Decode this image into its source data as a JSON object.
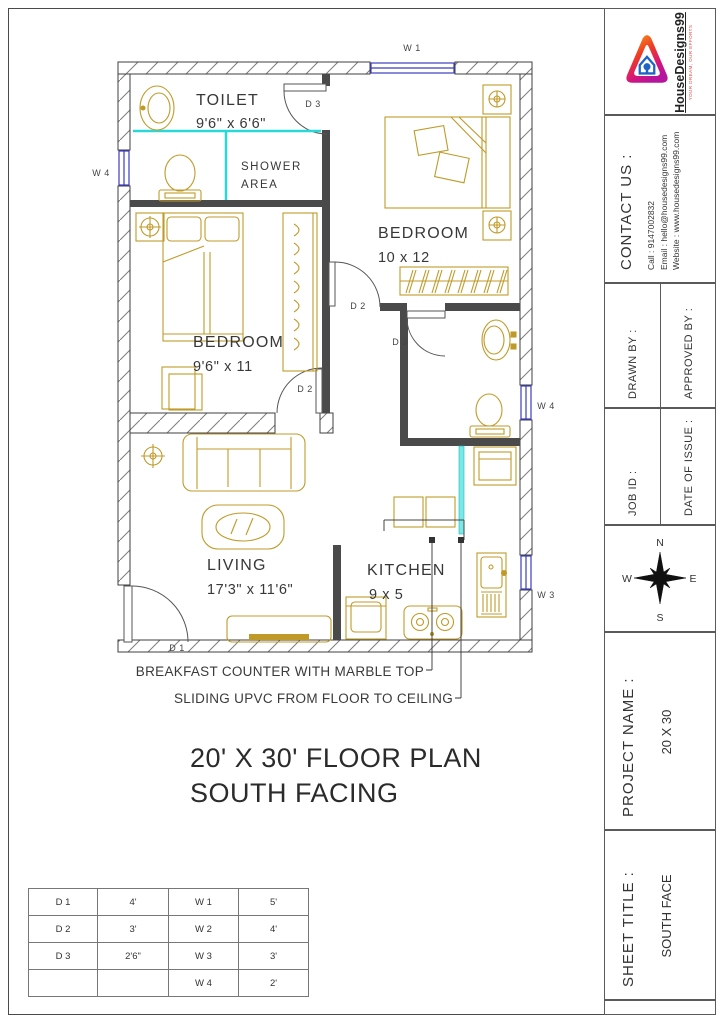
{
  "title_block": {
    "logo": {
      "name": "HouseDesigns99",
      "tagline": "YOUR DREAM, OUR EFFORTS"
    },
    "contact": {
      "heading": "CONTACT US :",
      "call": "Call : 9147002832",
      "email": "Email : hello@housedesigns99.com",
      "website": "Website : www.housedesigns99.com"
    },
    "drawn_by": "DRAWN BY :",
    "approved_by": "APPROVED BY :",
    "job_id": "JOB ID :",
    "date_of_issue": "DATE OF ISSUE :",
    "project_name_label": "PROJECT NAME :",
    "project_name_value": "20 X 30",
    "sheet_title_label": "SHEET TITLE :",
    "sheet_title_value": "SOUTH FACE",
    "compass": {
      "n": "N",
      "e": "E",
      "s": "S",
      "w": "W"
    }
  },
  "plan": {
    "rooms": {
      "toilet": {
        "name": "TOILET",
        "dims": "9'6\" x 6'6\""
      },
      "shower": {
        "line1": "SHOWER",
        "line2": "AREA"
      },
      "bedroom_master": {
        "name": "BEDROOM",
        "dims": "10 x 12"
      },
      "bedroom_second": {
        "name": "BEDROOM",
        "dims": "9'6\" x 11"
      },
      "living": {
        "name": "LIVING",
        "dims": "17'3\" x 11'6\""
      },
      "kitchen": {
        "name": "KITCHEN",
        "dims": "9 x 5"
      }
    },
    "doors": {
      "d1": "D 1",
      "d2": "D 2",
      "d3": "D 3"
    },
    "windows": {
      "w1": "W 1",
      "w3": "W 3",
      "w4": "W 4"
    },
    "annotations": {
      "breakfast": "BREAKFAST COUNTER WITH MARBLE TOP",
      "sliding": "SLIDING UPVC FROM FLOOR TO CEILING"
    },
    "title": {
      "line1": "20' X 30' FLOOR PLAN",
      "line2": "SOUTH FACING"
    }
  },
  "schedule": {
    "rows": [
      {
        "door": "D 1",
        "door_size": "4'",
        "window": "W 1",
        "window_size": "5'"
      },
      {
        "door": "D 2",
        "door_size": "3'",
        "window": "W 2",
        "window_size": "4'"
      },
      {
        "door": "D 3",
        "door_size": "2'6\"",
        "window": "W 3",
        "window_size": "3'"
      },
      {
        "door": "",
        "door_size": "",
        "window": "W 4",
        "window_size": "2'"
      }
    ]
  },
  "colors": {
    "wall": "#3f3f3f",
    "furniture": "#c09a28",
    "window_blue": "#3c3cc0",
    "glass_cyan": "#2ad8d8",
    "logo_gradient_top": "#f9a51a",
    "logo_gradient_mid": "#ef3b24",
    "logo_gradient_bottom": "#b5159c",
    "logo_house_blue": "#1e63c8"
  }
}
